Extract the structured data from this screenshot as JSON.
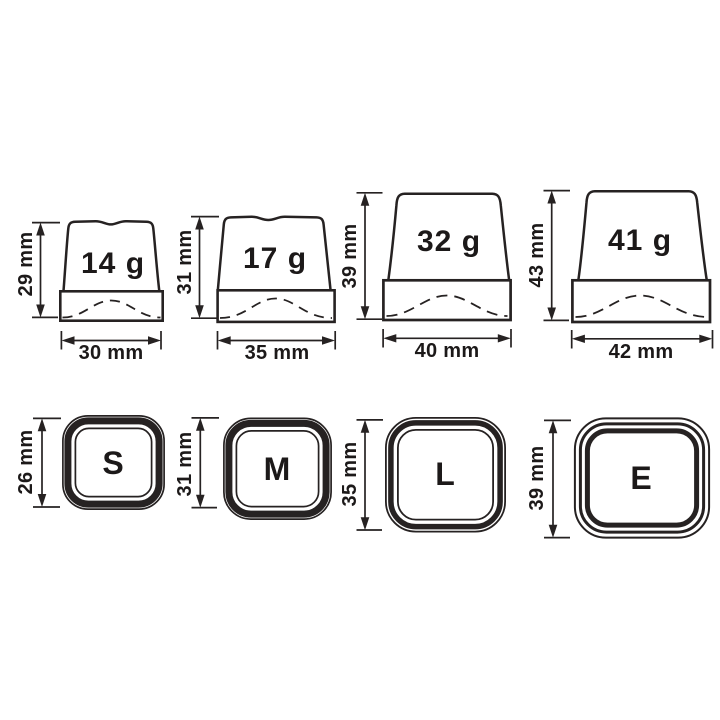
{
  "colors": {
    "line": "#262222",
    "text": "#1c1919",
    "background": "#ffffff"
  },
  "side_views": [
    {
      "weight": "14 g",
      "height": "29 mm",
      "width": "30 mm"
    },
    {
      "weight": "17 g",
      "height": "31 mm",
      "width": "35 mm"
    },
    {
      "weight": "32 g",
      "height": "39 mm",
      "width": "40 mm"
    },
    {
      "weight": "41 g",
      "height": "43 mm",
      "width": "42 mm"
    }
  ],
  "top_views": [
    {
      "label": "S",
      "size": "26 mm"
    },
    {
      "label": "M",
      "size": "31 mm"
    },
    {
      "label": "L",
      "size": "35 mm"
    },
    {
      "label": "E",
      "size": "39 mm"
    }
  ]
}
